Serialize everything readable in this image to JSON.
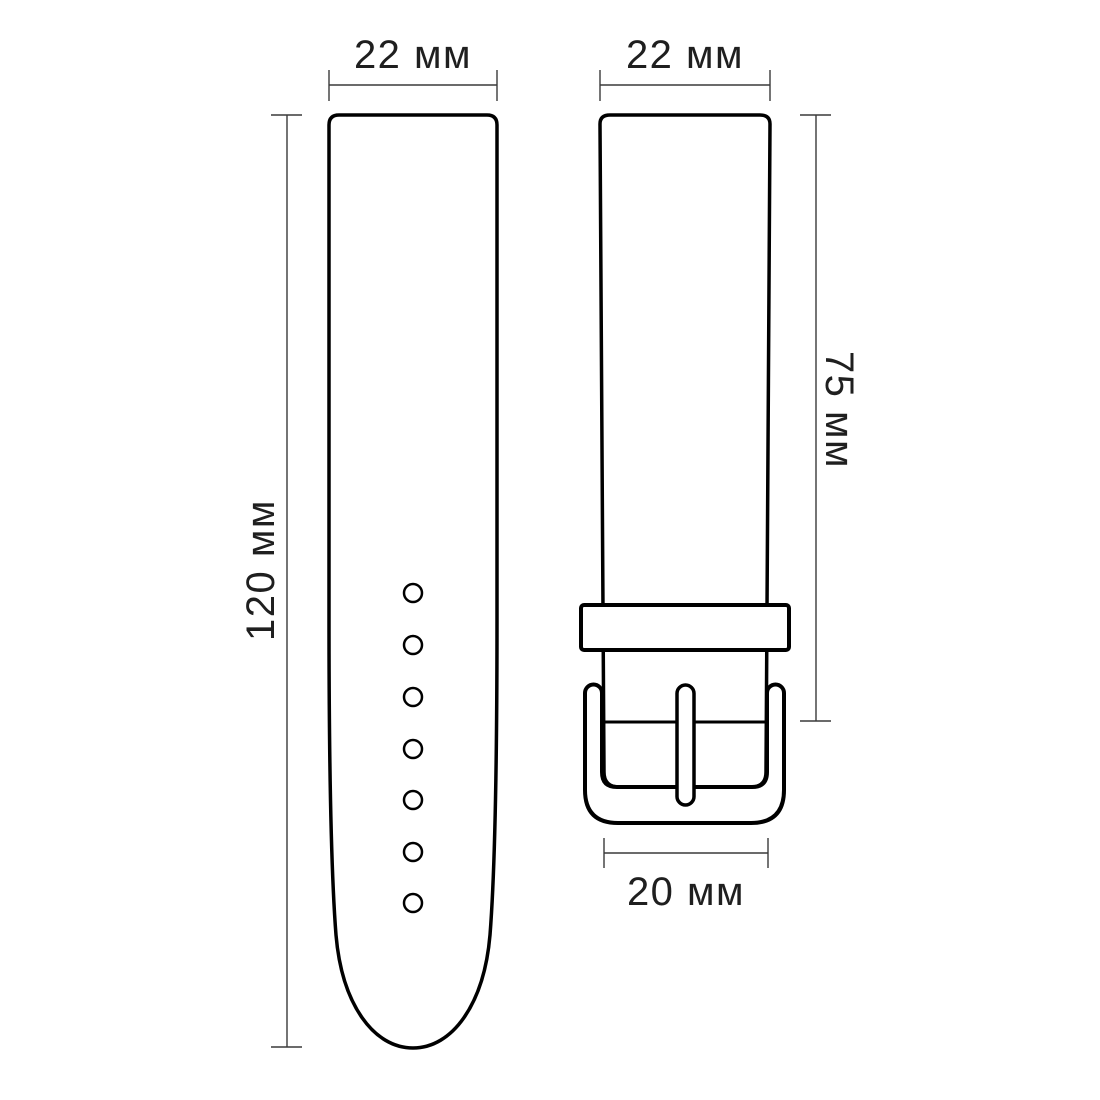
{
  "diagram": {
    "background_color": "#ffffff",
    "outline_color": "#000000",
    "dimension_color": "#3a3a3a",
    "tail_strap": {
      "width_label": "22 мм",
      "length_label": "120 мм",
      "holes_count": 7
    },
    "buckle_strap": {
      "width_label": "22 мм",
      "length_label": "75 мм",
      "buckle_width_label": "20 мм"
    }
  }
}
